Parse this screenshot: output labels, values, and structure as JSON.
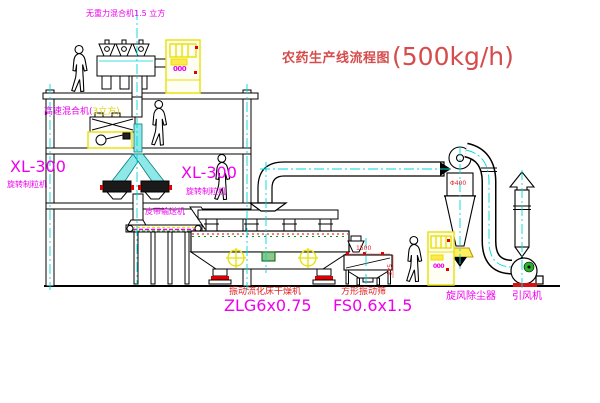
{
  "title": {
    "name": "农药生产线流程图",
    "capacity": "(500kg/h)"
  },
  "labels": {
    "gravity_mixer": "无重力混合机1.5 立方",
    "high_speed_mixer_p1": "高速混合机(",
    "high_speed_mixer_p2": "3立方)",
    "granulator_left_code": "XL-300",
    "granulator_left_name": "旋转制粒机",
    "granulator_right_code": "XL-300",
    "granulator_right_name": "旋转制粒机",
    "belt_conveyor": "皮带输送机",
    "dryer_name": "振动流化床干燥机",
    "dryer_code": "ZLG6x0.75",
    "sieve_name": "方形振动筛",
    "sieve_code": "FS0.6x1.5",
    "cyclone_name": "旋风除尘器",
    "cyclone_dim": "Φ400",
    "fan_name": "引风机",
    "dim_1500": "1500",
    "dim_545": "545",
    "cabinet_top_display": "000",
    "cabinet_bottom_display": "000"
  },
  "colors": {
    "magenta_label": "#ee00ee",
    "title_red": "#d64c4c",
    "dimension_red": "#e02222",
    "centerline_cyan": "#00d8d8",
    "cabinet_yellow": "#e8e000",
    "motor_green": "#2ab22a",
    "line_black": "#000000"
  }
}
